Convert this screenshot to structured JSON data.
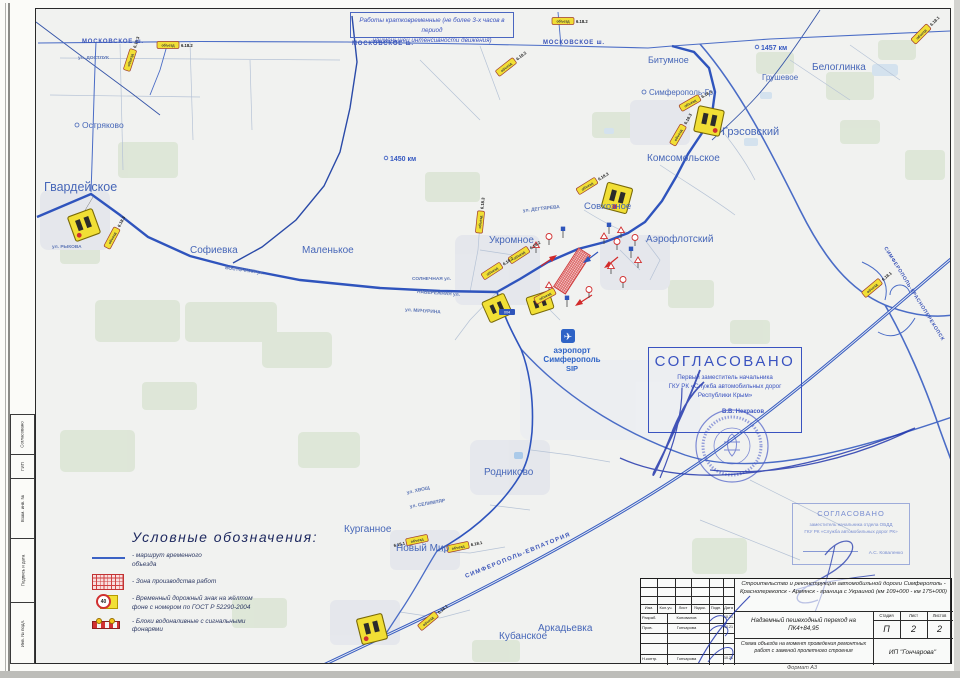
{
  "sheet": {
    "note_line1": "Работы кратковременные (не более 3-х часов в период",
    "note_line2": "наименьшей интенсивности движения)",
    "format_label": "Формат А3"
  },
  "frame_strip": {
    "box1": "Согласовано",
    "box1b": "ГИП",
    "box2": "Взам. инв. №",
    "box3": "Подпись и дата",
    "box4": "Инв. № подл."
  },
  "map": {
    "sign_word": "объезд",
    "route_plate": "004",
    "airport_icon": "✈",
    "airport": {
      "line1": "аэропорт",
      "line2": "Симферополь",
      "line3": "SIP"
    },
    "km_markers": {
      "k1450": "1450 км",
      "k1457": "1457 км"
    },
    "labels": [
      "МОСКОВСКОЕ ш.",
      "МОСКОВСКОЕ ш.",
      "МОСКОВСКОЕ ш.",
      "ул. ДОСТЛУК",
      "Битумное",
      "Белоглинка",
      "Грушевое",
      "Симферополь-Гр.",
      "Грэсовский",
      "Комсомольское",
      "Остряково",
      "Гвардейское",
      "ул. РЫКОВА",
      "Софиевка",
      "Маленькое",
      "ВОСТОЧНАЯ ул.",
      "СОЛНЕЧНАЯ ул.",
      "НАБЕРЕЖНАЯ ул.",
      "ул. МИЧУРИНА",
      "ул. ДЕГТЯРЕВА",
      "Совхозное",
      "Укромное",
      "Аэрофлотский",
      "Родниково",
      "ул. ХВОЩ",
      "ул. СЕЛИМЛЯР",
      "Курганное",
      "Новый Мир",
      "Аркадьевка",
      "Кубанское",
      "СИМФЕРОПОЛЬ-ЕВПАТОРИЯ",
      "СИМФЕРОПОЛЬ-КРАСНОПЕРЕКОПСК"
    ],
    "sign_numbers": [
      "6.18.2",
      "6.18.2",
      "6.18.3",
      "6.18.2",
      "6.18.1",
      "6.18.3",
      "6.18.3",
      "6.18.3",
      "6.18.3",
      "6.18.2",
      "6.18.2",
      "6.18.1",
      "6.18.1",
      "6.18.1",
      "6.18.1",
      "6.18.3"
    ]
  },
  "legend": {
    "title": "Условные обозначения:",
    "i1l1": "- маршрут временного",
    "i1l2": "объезда",
    "i2": "- Зона производства работ",
    "i3_badge": "40",
    "i3l1": "- Временный дорожный знак на жёлтом",
    "i3l2": "фоне с номером по ГОСТ Р 52290-2004",
    "i4l1": "- Блоки водоналивные с сигнальными",
    "i4l2": "фонарями"
  },
  "stamp": {
    "title": "СОГЛАСОВАНО",
    "line1": "Первый заместитель начальника",
    "line2": "ГКУ РК «Служба автомобильных дорог",
    "line3": "Республики Крым»",
    "name": "В.В. Некрасов"
  },
  "stamp2": {
    "title": "СОГЛАСОВАНО",
    "line1": "заместитель начальника отдела ОБДД",
    "line2": "ГКУ РК «Служба автомобильных дорог РК»",
    "name": "А.С. Коваленко"
  },
  "titleblock": {
    "project": "Строительство и реконструкция автомобильной дороги Симферополь - Красноперекопск - Армянск - граница с Украиной (км 109+000 - км 175+000)",
    "object": "Надземный пешеходный переход на ПК4+84,95",
    "sheet_title": "Схема объезда на момент проведения ремонтных работ с заменой пролетного строения",
    "org": "ИП \"Гончарова\"",
    "stage_label": "Стадия",
    "list_label": "Лист",
    "listov_label": "Листов",
    "stage": "П",
    "list": "2",
    "listov": "2",
    "col_izm": "Изм.",
    "col_koluch": "Кол.уч.",
    "col_list": "Лист",
    "col_ndok": "№док.",
    "col_podp": "Подп.",
    "col_data": "Дата",
    "r1_role": "Разраб.",
    "r1_name": "Коновалов",
    "r1_date": "10.21",
    "r2_role": "Пров.",
    "r2_name": "Гончарова",
    "r2_date": "10.21",
    "r5_role": "Н.контр.",
    "r5_name": "Гончарова",
    "r5_date": "10.21"
  }
}
